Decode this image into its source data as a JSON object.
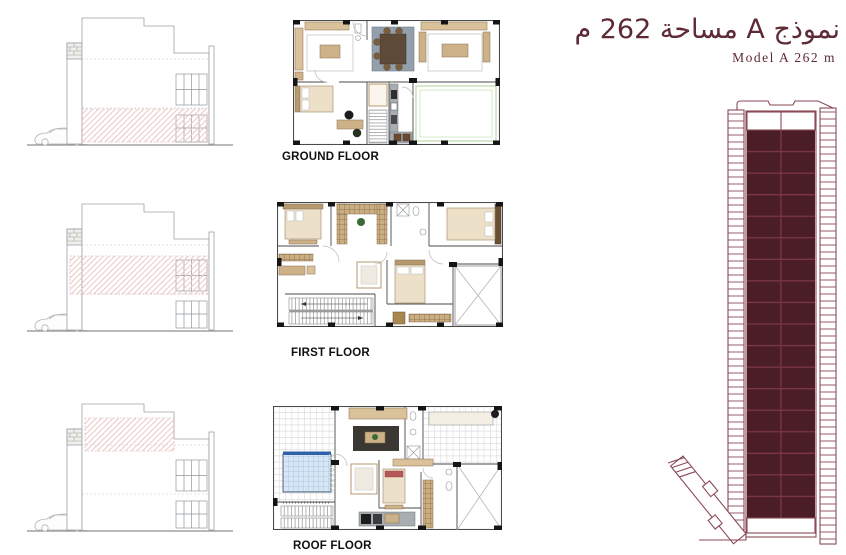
{
  "page": {
    "background_color": "#ffffff"
  },
  "header": {
    "title_arabic": "نموذج A مساحة 262 م",
    "title_english": "Model A 262 m",
    "accent_color": "#5e2a34"
  },
  "floor_plans": [
    {
      "label": "GROUND FLOOR"
    },
    {
      "label": "FIRST FLOOR"
    },
    {
      "label": "ROOF FLOOR"
    }
  ],
  "elevations": [
    {
      "highlighted_floor": "ground"
    },
    {
      "highlighted_floor": "first"
    },
    {
      "highlighted_floor": "roof"
    }
  ],
  "hatch": {
    "color": "#ecc8c8"
  },
  "key_plan": {
    "unit_fill_color": "#4a1d27",
    "outline_color": "#8a4a57",
    "grid_line_color": "#7c3644",
    "columns": 2,
    "filled_unit_rows": 18,
    "empty_unit_rows_top": 1,
    "rung_pitch": 7
  }
}
